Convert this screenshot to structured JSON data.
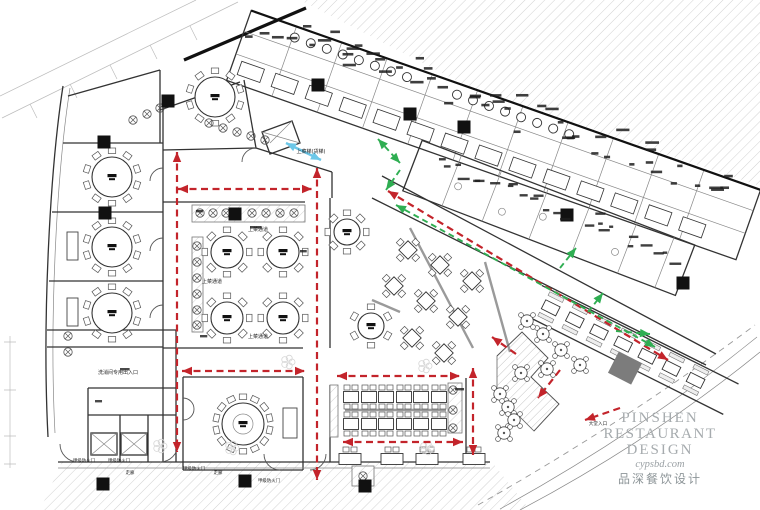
{
  "watermark": {
    "line1": "PINSHEN",
    "line2": "RESTAURANT",
    "line3": "DESIGN",
    "site": "cypsbd.com",
    "cn": "品深餐饮设计"
  },
  "colors": {
    "red": "#c3242b",
    "green": "#2fae52",
    "blue": "#6cc7e8",
    "wall": "#333333",
    "hatch": "#d2d2d2",
    "watermark_en": "#a6abae",
    "watermark_cn": "#8d9598",
    "watermark_site": "#9aa0a4"
  },
  "labels": [
    {
      "t": "上菜通道",
      "x": 258,
      "y": 231,
      "s": 5
    },
    {
      "t": "上菜通道",
      "x": 212,
      "y": 283,
      "s": 5
    },
    {
      "t": "上菜通道",
      "x": 258,
      "y": 338,
      "s": 5
    },
    {
      "t": "上菜梯(货梯)",
      "x": 311,
      "y": 153,
      "s": 5
    },
    {
      "t": "洗消间专用出入口",
      "x": 118,
      "y": 374,
      "s": 5
    },
    {
      "t": "甲级防火门",
      "x": 84,
      "y": 462,
      "s": 4.4
    },
    {
      "t": "甲级防火门",
      "x": 119,
      "y": 462,
      "s": 4.4
    },
    {
      "t": "甲级防火门",
      "x": 194,
      "y": 470,
      "s": 4.4
    },
    {
      "t": "甲级防火门",
      "x": 269,
      "y": 482,
      "s": 4.4
    },
    {
      "t": "走廊",
      "x": 130,
      "y": 474,
      "s": 4.4
    },
    {
      "t": "走廊",
      "x": 218,
      "y": 474,
      "s": 4.4
    },
    {
      "t": "大堂入口",
      "x": 598,
      "y": 425,
      "s": 4.6
    }
  ],
  "plan": {
    "round_tables": [
      {
        "x": 215,
        "y": 97,
        "r": 20,
        "n": 10
      },
      {
        "x": 112,
        "y": 177,
        "r": 20,
        "n": 10
      },
      {
        "x": 112,
        "y": 247,
        "r": 20,
        "n": 10
      },
      {
        "x": 112,
        "y": 313,
        "r": 20,
        "n": 10
      },
      {
        "x": 227,
        "y": 252,
        "r": 16,
        "n": 8
      },
      {
        "x": 283,
        "y": 252,
        "r": 16,
        "n": 8
      },
      {
        "x": 227,
        "y": 318,
        "r": 16,
        "n": 8
      },
      {
        "x": 283,
        "y": 318,
        "r": 16,
        "n": 8
      },
      {
        "x": 347,
        "y": 232,
        "r": 13,
        "n": 8
      },
      {
        "x": 371,
        "y": 326,
        "r": 13,
        "n": 6
      },
      {
        "x": 243,
        "y": 424,
        "r": 21,
        "n": 14,
        "inner": 10
      }
    ],
    "rect_rows": [
      {
        "y": 397,
        "xs": [
          351,
          369,
          386,
          404,
          421,
          439
        ],
        "w": 15,
        "h": 11,
        "c": "tb"
      },
      {
        "y": 424,
        "xs": [
          351,
          369,
          386,
          404,
          421,
          439
        ],
        "w": 15,
        "h": 11,
        "c": "tb"
      },
      {
        "y": 459,
        "xs": [
          350,
          392,
          427,
          474
        ],
        "w": 22,
        "h": 11,
        "c": "t"
      }
    ],
    "diamond_tables": [
      [
        408,
        250
      ],
      [
        440,
        265
      ],
      [
        472,
        281
      ],
      [
        394,
        286
      ],
      [
        426,
        301
      ],
      [
        458,
        317
      ],
      [
        412,
        338
      ],
      [
        444,
        353
      ]
    ],
    "columns": [
      [
        168,
        101
      ],
      [
        104,
        142
      ],
      [
        105,
        213
      ],
      [
        235,
        214
      ],
      [
        318,
        85
      ],
      [
        410,
        114
      ],
      [
        464,
        127
      ],
      [
        567,
        215
      ],
      [
        683,
        283
      ],
      [
        245,
        481
      ],
      [
        103,
        484
      ],
      [
        365,
        486
      ]
    ],
    "counters": [
      [
        192,
        205,
        113,
        17
      ],
      [
        192,
        237,
        11,
        95
      ],
      [
        448,
        383,
        14,
        50
      ],
      [
        330,
        385,
        8,
        52
      ],
      [
        352,
        466,
        22,
        20
      ]
    ],
    "cabinets": [
      [
        67,
        232,
        11,
        28
      ],
      [
        67,
        298,
        11,
        28
      ],
      [
        283,
        408,
        14,
        30
      ]
    ],
    "plants": [
      [
        200,
        213
      ],
      [
        213,
        213
      ],
      [
        226,
        213
      ],
      [
        252,
        213
      ],
      [
        266,
        213
      ],
      [
        280,
        213
      ],
      [
        294,
        213
      ],
      [
        197,
        246
      ],
      [
        197,
        262
      ],
      [
        197,
        278
      ],
      [
        197,
        294
      ],
      [
        197,
        310
      ],
      [
        197,
        325
      ],
      [
        133,
        120
      ],
      [
        147,
        114
      ],
      [
        160,
        108
      ],
      [
        209,
        123
      ],
      [
        223,
        128
      ],
      [
        237,
        132
      ],
      [
        251,
        136
      ],
      [
        265,
        140
      ],
      [
        453,
        390
      ],
      [
        453,
        410
      ],
      [
        453,
        428
      ],
      [
        363,
        476
      ],
      [
        68,
        336
      ],
      [
        68,
        352
      ]
    ],
    "plant_tables": [
      [
        543,
        334
      ],
      [
        561,
        350
      ],
      [
        580,
        365
      ],
      [
        547,
        369
      ],
      [
        527,
        321
      ],
      [
        500,
        394
      ],
      [
        508,
        407
      ],
      [
        514,
        420
      ],
      [
        504,
        433
      ],
      [
        521,
        373
      ]
    ],
    "ornaments": [
      [
        232,
        448
      ],
      [
        425,
        366
      ],
      [
        427,
        448
      ],
      [
        288,
        362
      ],
      [
        160,
        446
      ]
    ],
    "arrows": [
      {
        "c": "red",
        "pts": [
          [
            178,
            189
          ],
          [
            312,
            189
          ]
        ],
        "h": "both"
      },
      {
        "c": "red",
        "pts": [
          [
            177,
            152
          ],
          [
            177,
            452
          ]
        ],
        "h": "both"
      },
      {
        "c": "red",
        "pts": [
          [
            317,
            168
          ],
          [
            317,
            480
          ]
        ],
        "h": "both"
      },
      {
        "c": "red",
        "pts": [
          [
            182,
            371
          ],
          [
            305,
            371
          ]
        ],
        "h": "both"
      },
      {
        "c": "red",
        "pts": [
          [
            337,
            376
          ],
          [
            460,
            376
          ]
        ],
        "h": "both"
      },
      {
        "c": "red",
        "pts": [
          [
            343,
            442
          ],
          [
            463,
            442
          ]
        ],
        "h": "both"
      },
      {
        "c": "red",
        "pts": [
          [
            473,
            368
          ],
          [
            473,
            455
          ]
        ],
        "h": "both"
      },
      {
        "c": "red",
        "pts": [
          [
            388,
            191
          ],
          [
            668,
            360
          ]
        ],
        "h": "both"
      },
      {
        "c": "red",
        "pts": [
          [
            560,
            370
          ],
          [
            538,
            398
          ]
        ],
        "h": "end"
      },
      {
        "c": "red",
        "pts": [
          [
            620,
            408
          ],
          [
            585,
            420
          ]
        ],
        "h": "end"
      },
      {
        "c": "red",
        "pts": [
          [
            516,
            354
          ],
          [
            492,
            337
          ]
        ],
        "h": "end"
      },
      {
        "c": "green",
        "pts": [
          [
            396,
            205
          ],
          [
            655,
            347
          ]
        ],
        "h": "both"
      },
      {
        "c": "green",
        "pts": [
          [
            378,
            139
          ],
          [
            400,
            163
          ]
        ],
        "h": "both"
      },
      {
        "c": "green",
        "pts": [
          [
            400,
            170
          ],
          [
            386,
            190
          ]
        ],
        "h": "end"
      },
      {
        "c": "green",
        "pts": [
          [
            560,
            268
          ],
          [
            576,
            248
          ]
        ],
        "h": "end"
      },
      {
        "c": "green",
        "pts": [
          [
            588,
            312
          ],
          [
            603,
            293
          ]
        ],
        "h": "end"
      },
      {
        "c": "green",
        "pts": [
          [
            616,
            331
          ],
          [
            650,
            334
          ]
        ],
        "h": "end"
      },
      {
        "c": "blue",
        "pts": [
          [
            286,
            143
          ],
          [
            321,
            160
          ]
        ],
        "h": "both"
      }
    ]
  }
}
